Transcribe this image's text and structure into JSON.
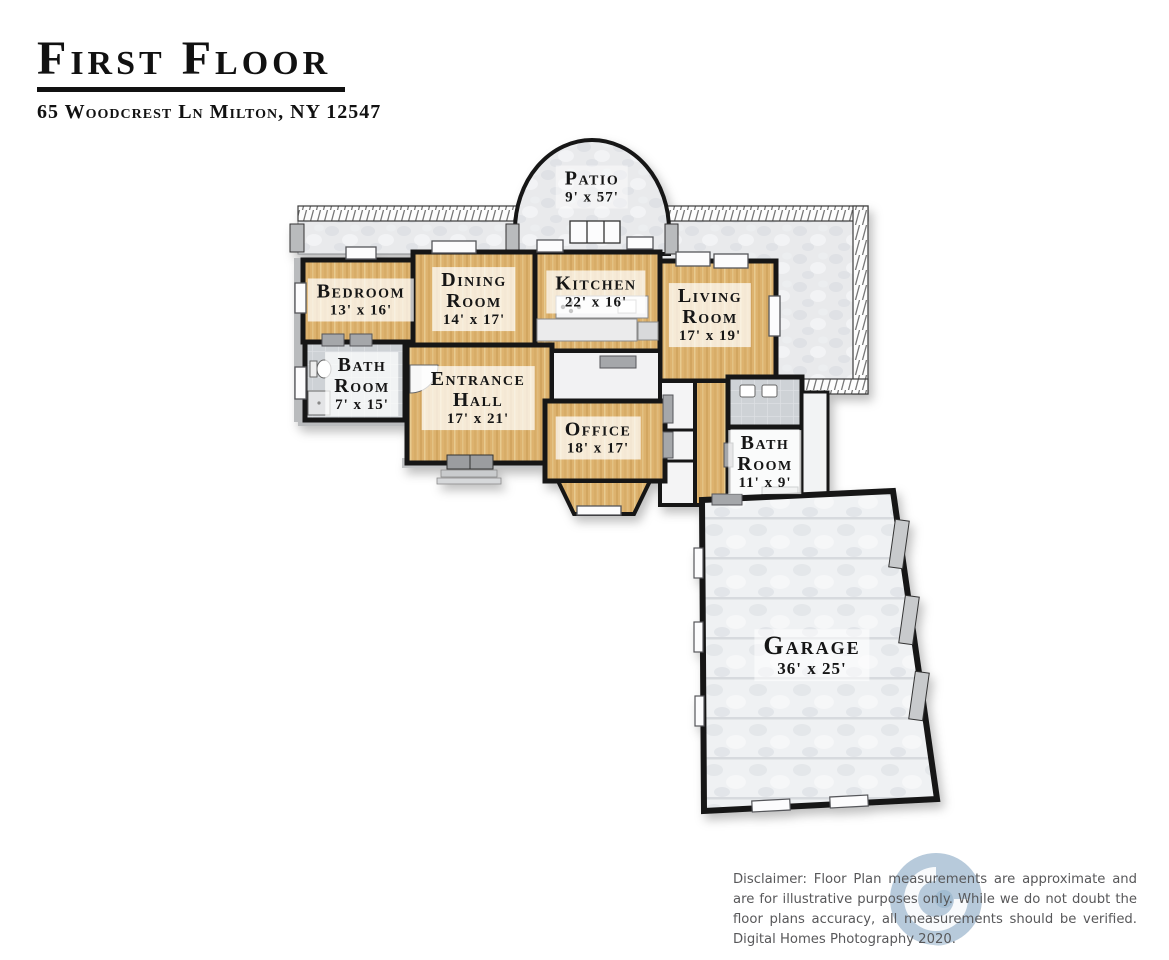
{
  "header": {
    "title": "First Floor",
    "address": "65 Woodcrest Ln Milton, NY 12547"
  },
  "rooms": [
    {
      "id": "patio",
      "name": "Patio",
      "dims": "9' x 57'"
    },
    {
      "id": "bedroom",
      "name": "Bedroom",
      "dims": "13' x 16'"
    },
    {
      "id": "dining",
      "name": "Dining\nRoom",
      "dims": "14' x 17'"
    },
    {
      "id": "kitchen",
      "name": "Kitchen",
      "dims": "22' x 16'"
    },
    {
      "id": "living",
      "name": "Living\nRoom",
      "dims": "17' x 19'"
    },
    {
      "id": "bath1",
      "name": "Bath\nRoom",
      "dims": "7' x 15'"
    },
    {
      "id": "entrance",
      "name": "Entrance\nHall",
      "dims": "17' x 21'"
    },
    {
      "id": "office",
      "name": "Office",
      "dims": "18' x 17'"
    },
    {
      "id": "bath2",
      "name": "Bath\nRoom",
      "dims": "11' x 9'"
    },
    {
      "id": "garage",
      "name": "Garage",
      "dims": "36' x 25'"
    }
  ],
  "footer": {
    "disclaimer": "Disclaimer: Floor Plan measurements are approximate and are for illustrative purposes only. While we do not doubt the floor plans accuracy, all measurements should be verified. Digital Homes Photography 2020."
  },
  "colors": {
    "wood_floor": "#ddb26e",
    "stone_deck": "#e9eaec",
    "garage_concrete": "#eff1f3",
    "wall": "#161616",
    "label_text": "#161616",
    "disclaimer_text": "#58585a",
    "watermark_blue": "#b7cadb"
  }
}
